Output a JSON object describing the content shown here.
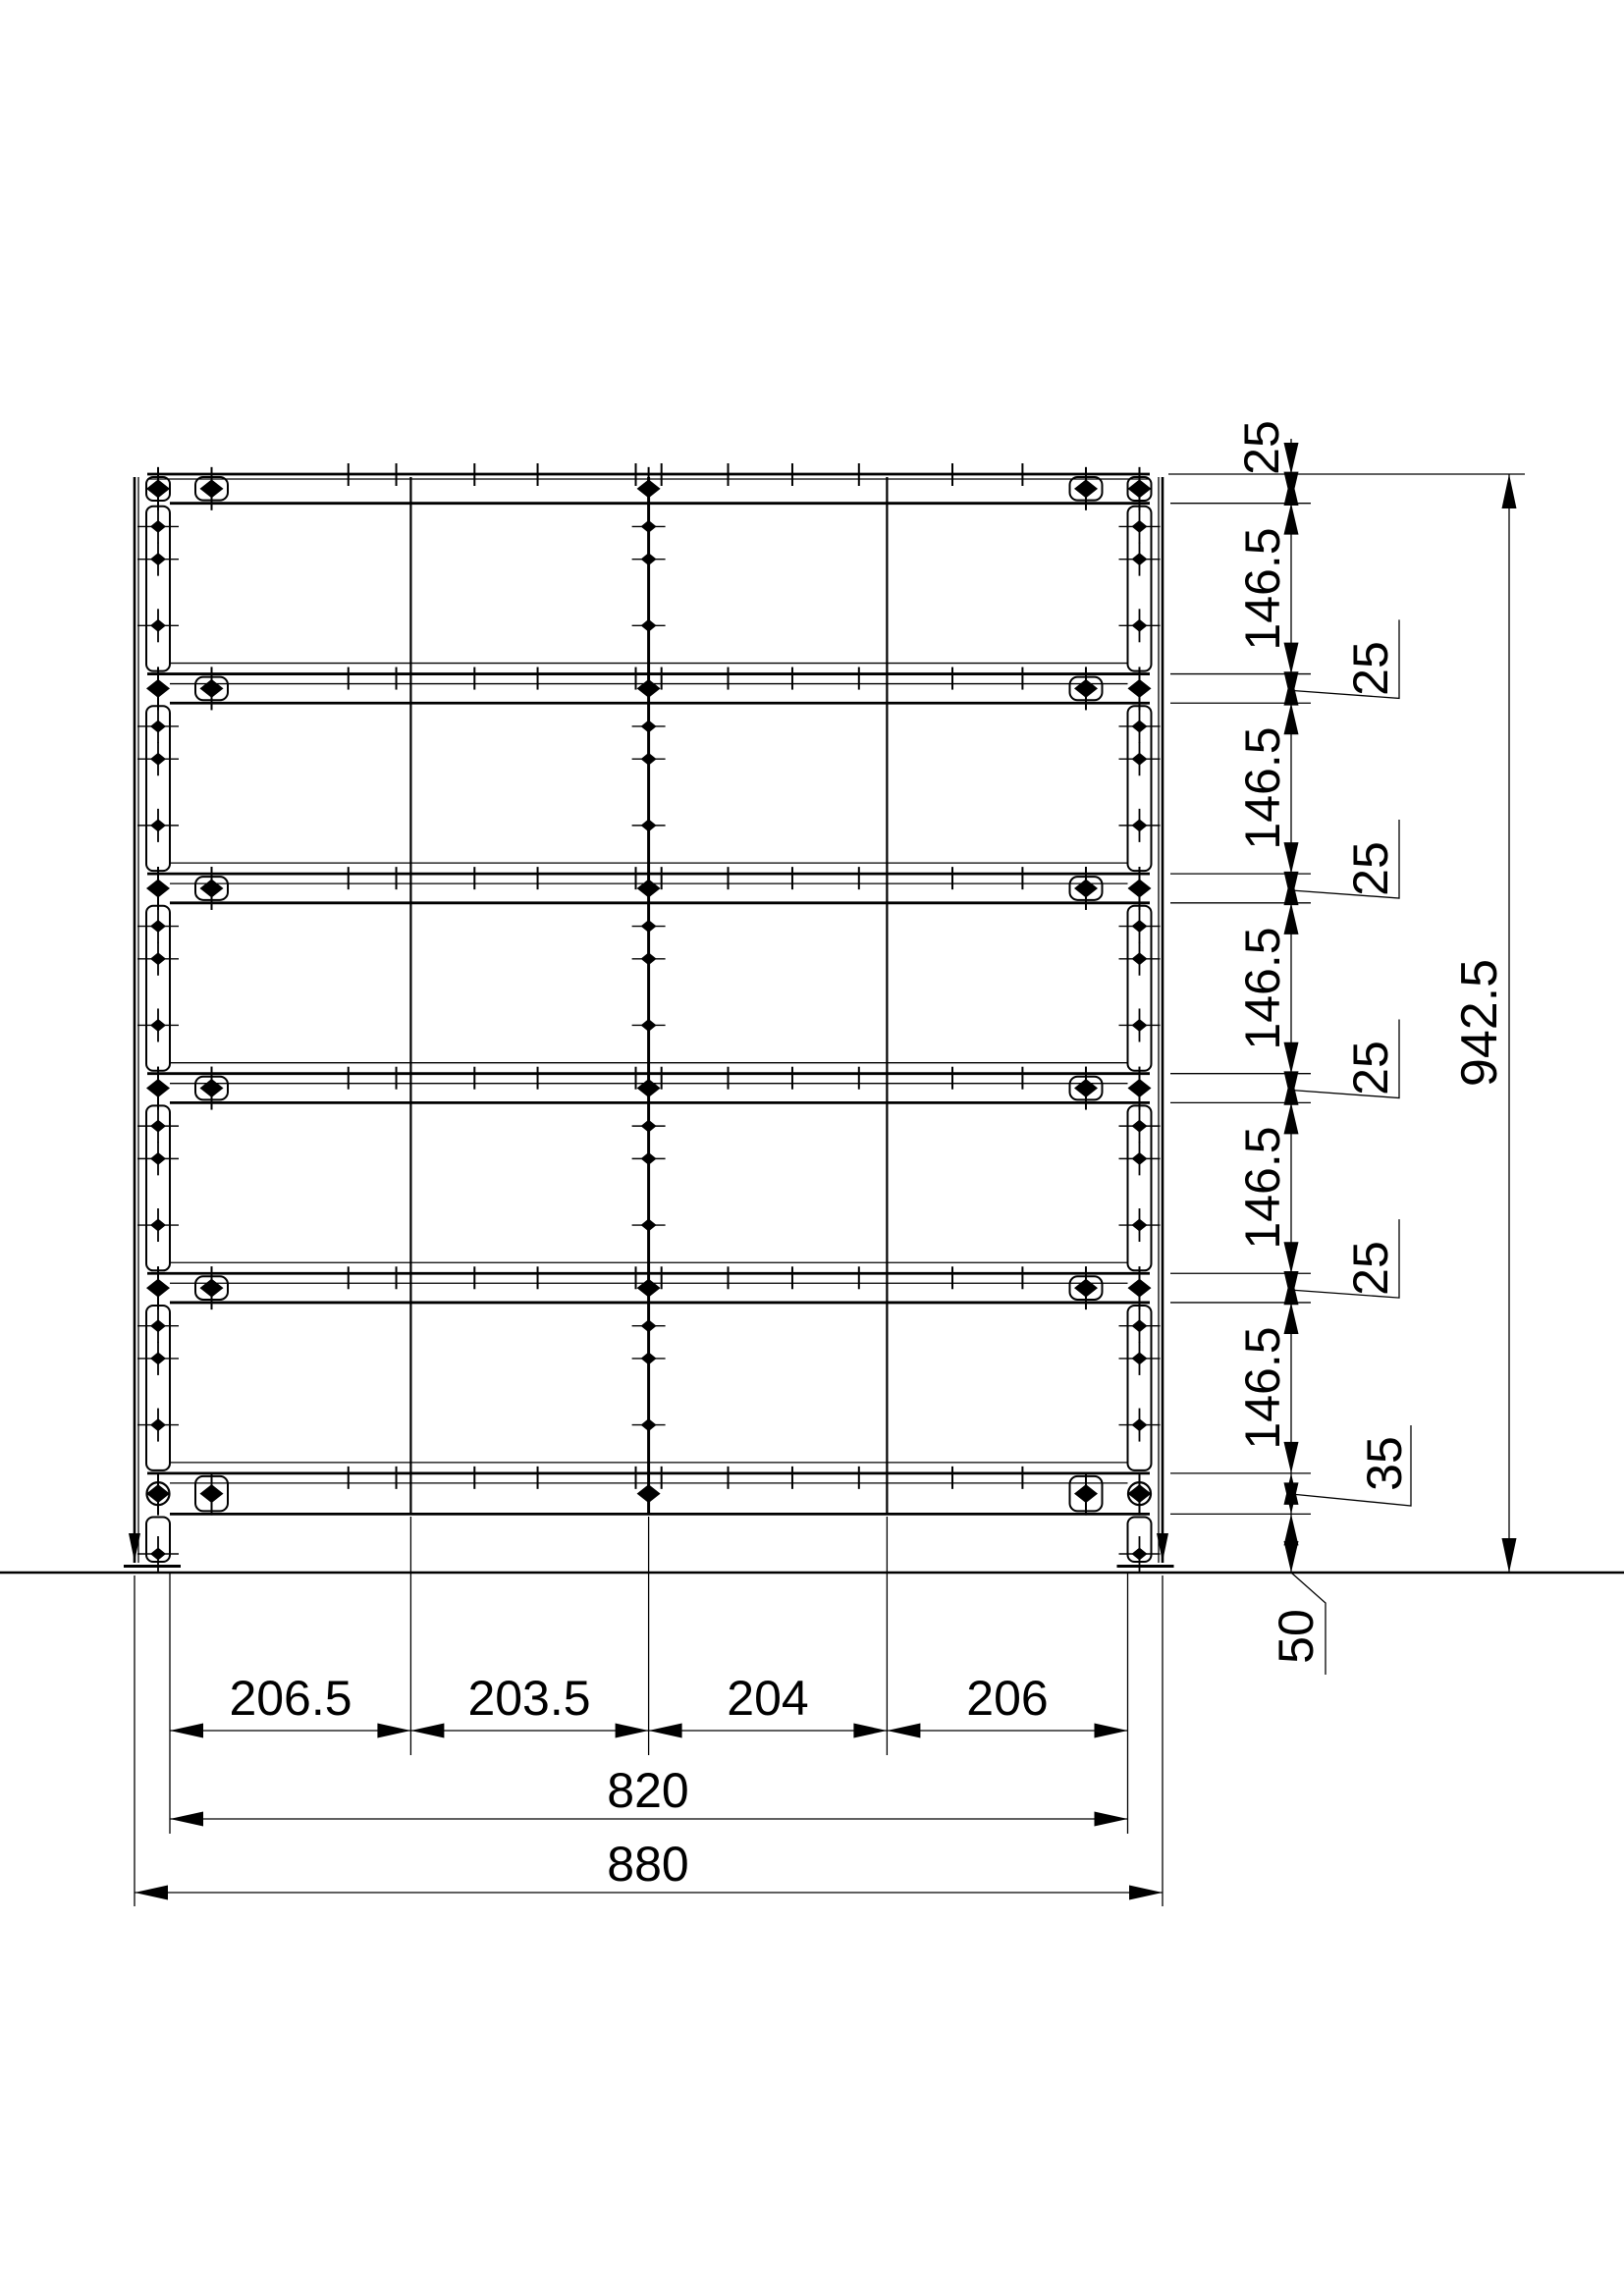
{
  "drawing": {
    "kind": "rack-front-view",
    "line_color": "#000000",
    "background": "#ffffff",
    "dimensions": {
      "horizontal": {
        "segments": [
          "206.5",
          "203.5",
          "204",
          "206"
        ],
        "inner_width": "820",
        "overall_width": "880"
      },
      "vertical": {
        "top_rail": "25",
        "gap_labels": [
          "146.5",
          "146.5",
          "146.5",
          "146.5",
          "146.5"
        ],
        "rail_labels": [
          "25",
          "25",
          "25",
          "25"
        ],
        "bottom_rail": "35",
        "ground_clearance": "50",
        "overall_height": "942.5"
      }
    }
  }
}
